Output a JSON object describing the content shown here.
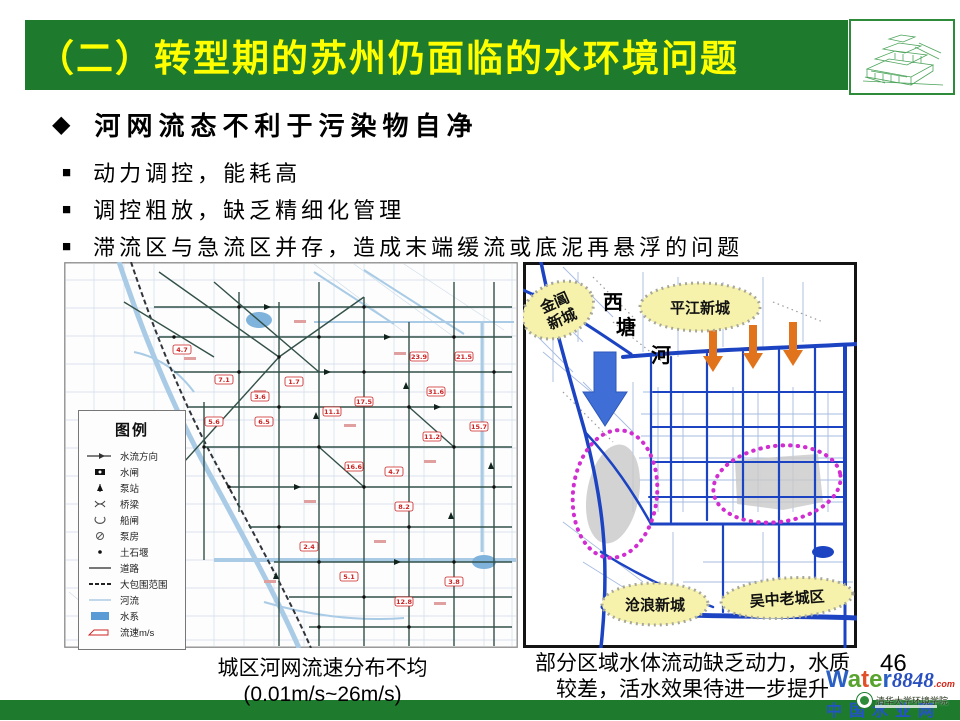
{
  "slide": {
    "title": "（二）转型期的苏州仍面临的水环境问题",
    "page_number": "46"
  },
  "bullets": {
    "heading": "河网流态不利于污染物自净",
    "items": [
      "动力调控，能耗高",
      "调控粗放，缺乏精细化管理",
      "滞流区与急流区并存，造成末端缓流或底泥再悬浮的问题"
    ]
  },
  "map_left": {
    "caption_line1": "城区河网流速分布不均",
    "caption_line2": "(0.01m/s~26m/s)",
    "legend": {
      "title": "图例",
      "items": [
        {
          "icon": "flow-direction-icon",
          "label": "水流方向"
        },
        {
          "icon": "sluice-gate-icon",
          "label": "水闸"
        },
        {
          "icon": "pump-station-icon",
          "label": "泵站"
        },
        {
          "icon": "bridge-icon",
          "label": "桥梁"
        },
        {
          "icon": "ship-lock-icon",
          "label": "船闸"
        },
        {
          "icon": "pump-house-icon",
          "label": "泵房"
        },
        {
          "icon": "weir-icon",
          "label": "土石堰"
        },
        {
          "icon": "road-icon",
          "label": "道路"
        },
        {
          "icon": "enclosure-boundary-icon",
          "label": "大包围范围"
        },
        {
          "icon": "river-icon",
          "label": "河流"
        },
        {
          "icon": "water-system-icon",
          "label": "水系"
        },
        {
          "icon": "velocity-box-icon",
          "label": "流速m/s"
        }
      ]
    },
    "velocity_labels": [
      "4.7",
      "7.1",
      "6.5",
      "5.6",
      "1.7",
      "3.6",
      "11.1",
      "17.5",
      "16.6",
      "23.9",
      "21.5",
      "31.6",
      "15.7",
      "11.2",
      "4.7",
      "8.2",
      "2.4",
      "5.1",
      "3.8",
      "12.8"
    ]
  },
  "map_right": {
    "caption_line1": "部分区域水体流动缺乏动力，水质",
    "caption_line2": "较差，活水效果待进一步提升",
    "labels": {
      "jinchang_line1": "金阊",
      "jinchang_line2": "新城",
      "pingjiang": "平江新城",
      "canglang": "沧浪新城",
      "wuzhong": "吴中老城区",
      "river_char1": "西",
      "river_char2": "塘",
      "river_char3": "河"
    }
  },
  "footer": {
    "brand_w": "W",
    "brand_a": "a",
    "brand_t": "t",
    "brand_e": "e",
    "brand_r": "r",
    "brand_number": "8848",
    "brand_com": ".com",
    "watermark_cn": "中国水业网",
    "emblem_text": "清华大学环境学院"
  },
  "colors": {
    "header_green": "#1e7b2e",
    "title_yellow": "#ffff00",
    "map_river_blue": "#1c43c2",
    "highlight_magenta": "#d02ed0",
    "arrow_orange": "#e2731d",
    "arrow_blue": "#3f6fd6",
    "label_yellow_fill": "#f6f2ac",
    "velocity_red": "#cc2222"
  }
}
